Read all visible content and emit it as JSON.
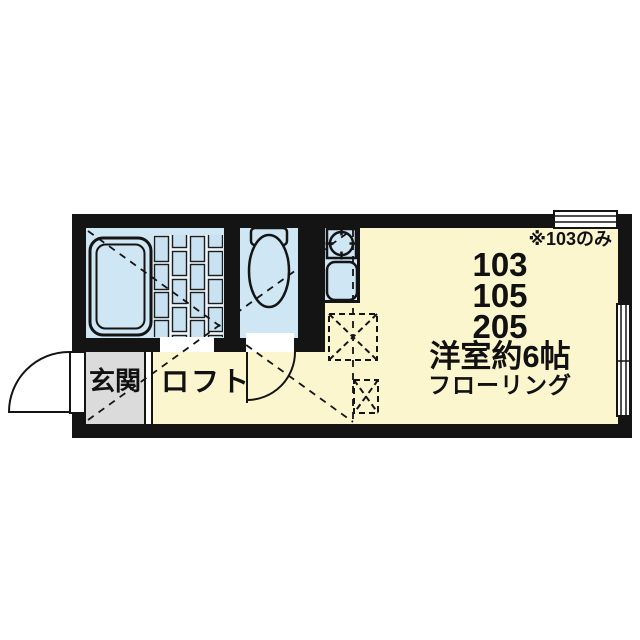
{
  "floorplan": {
    "title": "studio-apartment-floor-plan",
    "labels": {
      "note": "※103のみ",
      "units": [
        "103",
        "105",
        "205"
      ],
      "room_type": "洋室約6帖",
      "flooring": "フローリング",
      "entrance": "玄関",
      "loft": "ロフト"
    },
    "icons": [
      "bathtub-icon",
      "tiled-floor-icon",
      "toilet-icon",
      "stove-burner-icon",
      "sink-icon",
      "entry-door-swing-icon",
      "toilet-door-swing-icon",
      "window-icon",
      "loft-hatch-icon",
      "loft-extent-dashed-lines"
    ],
    "colors": {
      "wall": "#141414",
      "room_floor": "#fcf6ce",
      "wet_area": "#cfe6f4",
      "entrance_floor": "#dbdbdb",
      "background": "#ffffff",
      "line": "#141414"
    }
  }
}
